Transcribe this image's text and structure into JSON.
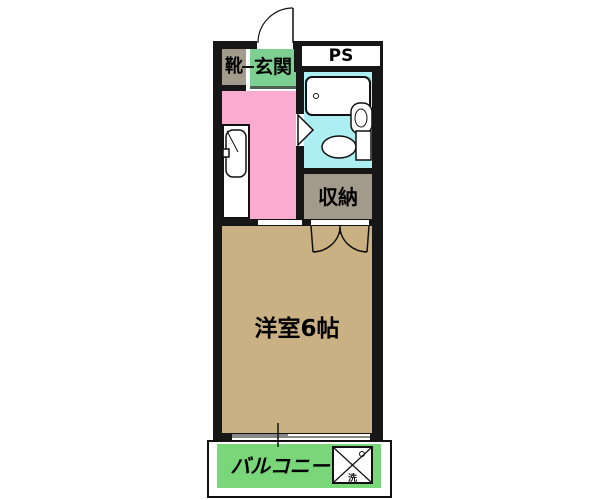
{
  "floor_plan": {
    "type": "japanese-apartment-1k-floorplan",
    "rooms": {
      "shoe_cabinet": {
        "label": "靴",
        "color": "#a29a8a"
      },
      "entrance": {
        "label": "玄関",
        "color": "#7ecf92"
      },
      "pipe_space": {
        "label": "PS",
        "color": "#ffffff"
      },
      "bathroom": {
        "label": "",
        "color": "#aceef2"
      },
      "kitchen_hallway": {
        "label": "",
        "color": "#f9abd0"
      },
      "storage": {
        "label": "収納",
        "color": "#a29a8a"
      },
      "western_room": {
        "label": "洋室6帖",
        "color": "#cab183"
      },
      "balcony": {
        "label": "バルコニー",
        "color": "#79d779"
      }
    },
    "fixtures": {
      "washing_machine_pan_label": "洗"
    },
    "colors": {
      "wall": "#161616",
      "background": "#ffffff",
      "entrance_step_line": "#4f5f55"
    }
  }
}
